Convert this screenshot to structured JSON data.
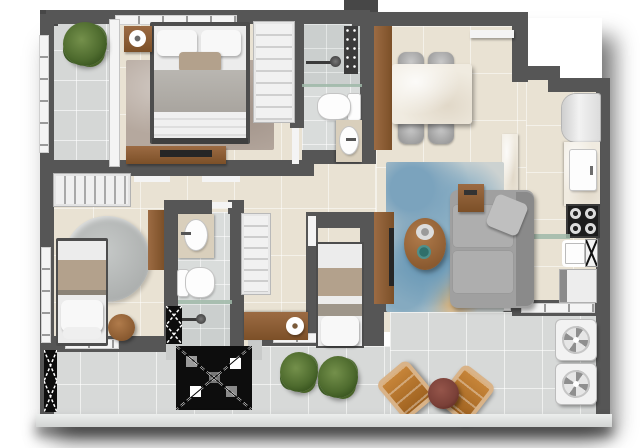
{
  "image": {
    "type": "apartment-floor-plan-3d-render",
    "view": "top-down",
    "text_labels": "none"
  },
  "palette": {
    "wall": "#565656",
    "wall_dark": "#474747",
    "floor": "#e9e2d3",
    "bath_floor": "#d9dcdb",
    "balcony_floor": "#d7d9d8",
    "wood": "#9c6b43",
    "wood_dark": "#7c5028",
    "marble": "#f0ebe0",
    "sofa": "#a0a0a0",
    "chair_gray": "#9d9d9d",
    "rug_blue": "#7ba3bd",
    "rug_taupe": "#b5a89e",
    "plant_green": "#4e6b2e",
    "leather_tan": "#b06f2a",
    "table_burgundy": "#7a4038",
    "glass": "#9fb9a8",
    "fixture": "#f4f4f4",
    "shaft": "#0d0d0d",
    "blanket_tan": "#b3a18c",
    "blanket_gray": "#b9b6b1",
    "tv_black": "#262626"
  },
  "rooms": [
    {
      "id": "master-bedroom",
      "furniture": [
        "double-bed",
        "area-rug",
        "nightstand-with-tray",
        "shelved-wardrobe",
        "dresser-with-tv",
        "corner-plant",
        "private-tiled-strip"
      ]
    },
    {
      "id": "bathroom-1",
      "furniture": [
        "shower",
        "shower-head",
        "glass-partition",
        "toilet",
        "vanity-sink",
        "door-leaf"
      ]
    },
    {
      "id": "dining-room",
      "furniture": [
        "marble-dining-table",
        "four-gray-chairs",
        "wood-wall-panel",
        "floating-shelf"
      ]
    },
    {
      "id": "kitchen",
      "furniture": [
        "refrigerator",
        "counter-with-sink-cabinet",
        "four-burner-cooktop",
        "glass-shelf",
        "marble-peninsula"
      ]
    },
    {
      "id": "service-area",
      "furniture": [
        "laundry-sink",
        "drying-rack-hatch",
        "washing-machine"
      ]
    },
    {
      "id": "living-room",
      "furniture": [
        "l-shaped-sofa",
        "throw-pillow",
        "blue-patterned-rug",
        "oval-coffee-table",
        "tray",
        "teal-bowl",
        "wood-end-table",
        "tv-wood-panel",
        "tv"
      ]
    },
    {
      "id": "bedroom-2",
      "furniture": [
        "single-bed",
        "round-rug",
        "round-side-table",
        "hanger-closet",
        "wall-ledge",
        "window"
      ]
    },
    {
      "id": "bathroom-2",
      "furniture": [
        "vanity-sink",
        "toilet",
        "glass-shelf",
        "shower",
        "shower-hatch"
      ]
    },
    {
      "id": "bedroom-3",
      "furniture": [
        "single-bed",
        "shelved-wardrobe",
        "wood-desk",
        "paper-roll-decor"
      ]
    },
    {
      "id": "balcony",
      "furniture": [
        "lounge-chair-left",
        "lounge-chair-right",
        "round-burgundy-table",
        "planter-1",
        "planter-2",
        "shaft-hatch",
        "side-shaft-hatch",
        "perimeter-curb"
      ]
    },
    {
      "id": "ac-ledge",
      "furniture": [
        "condenser-unit-1",
        "condenser-unit-2"
      ]
    }
  ]
}
